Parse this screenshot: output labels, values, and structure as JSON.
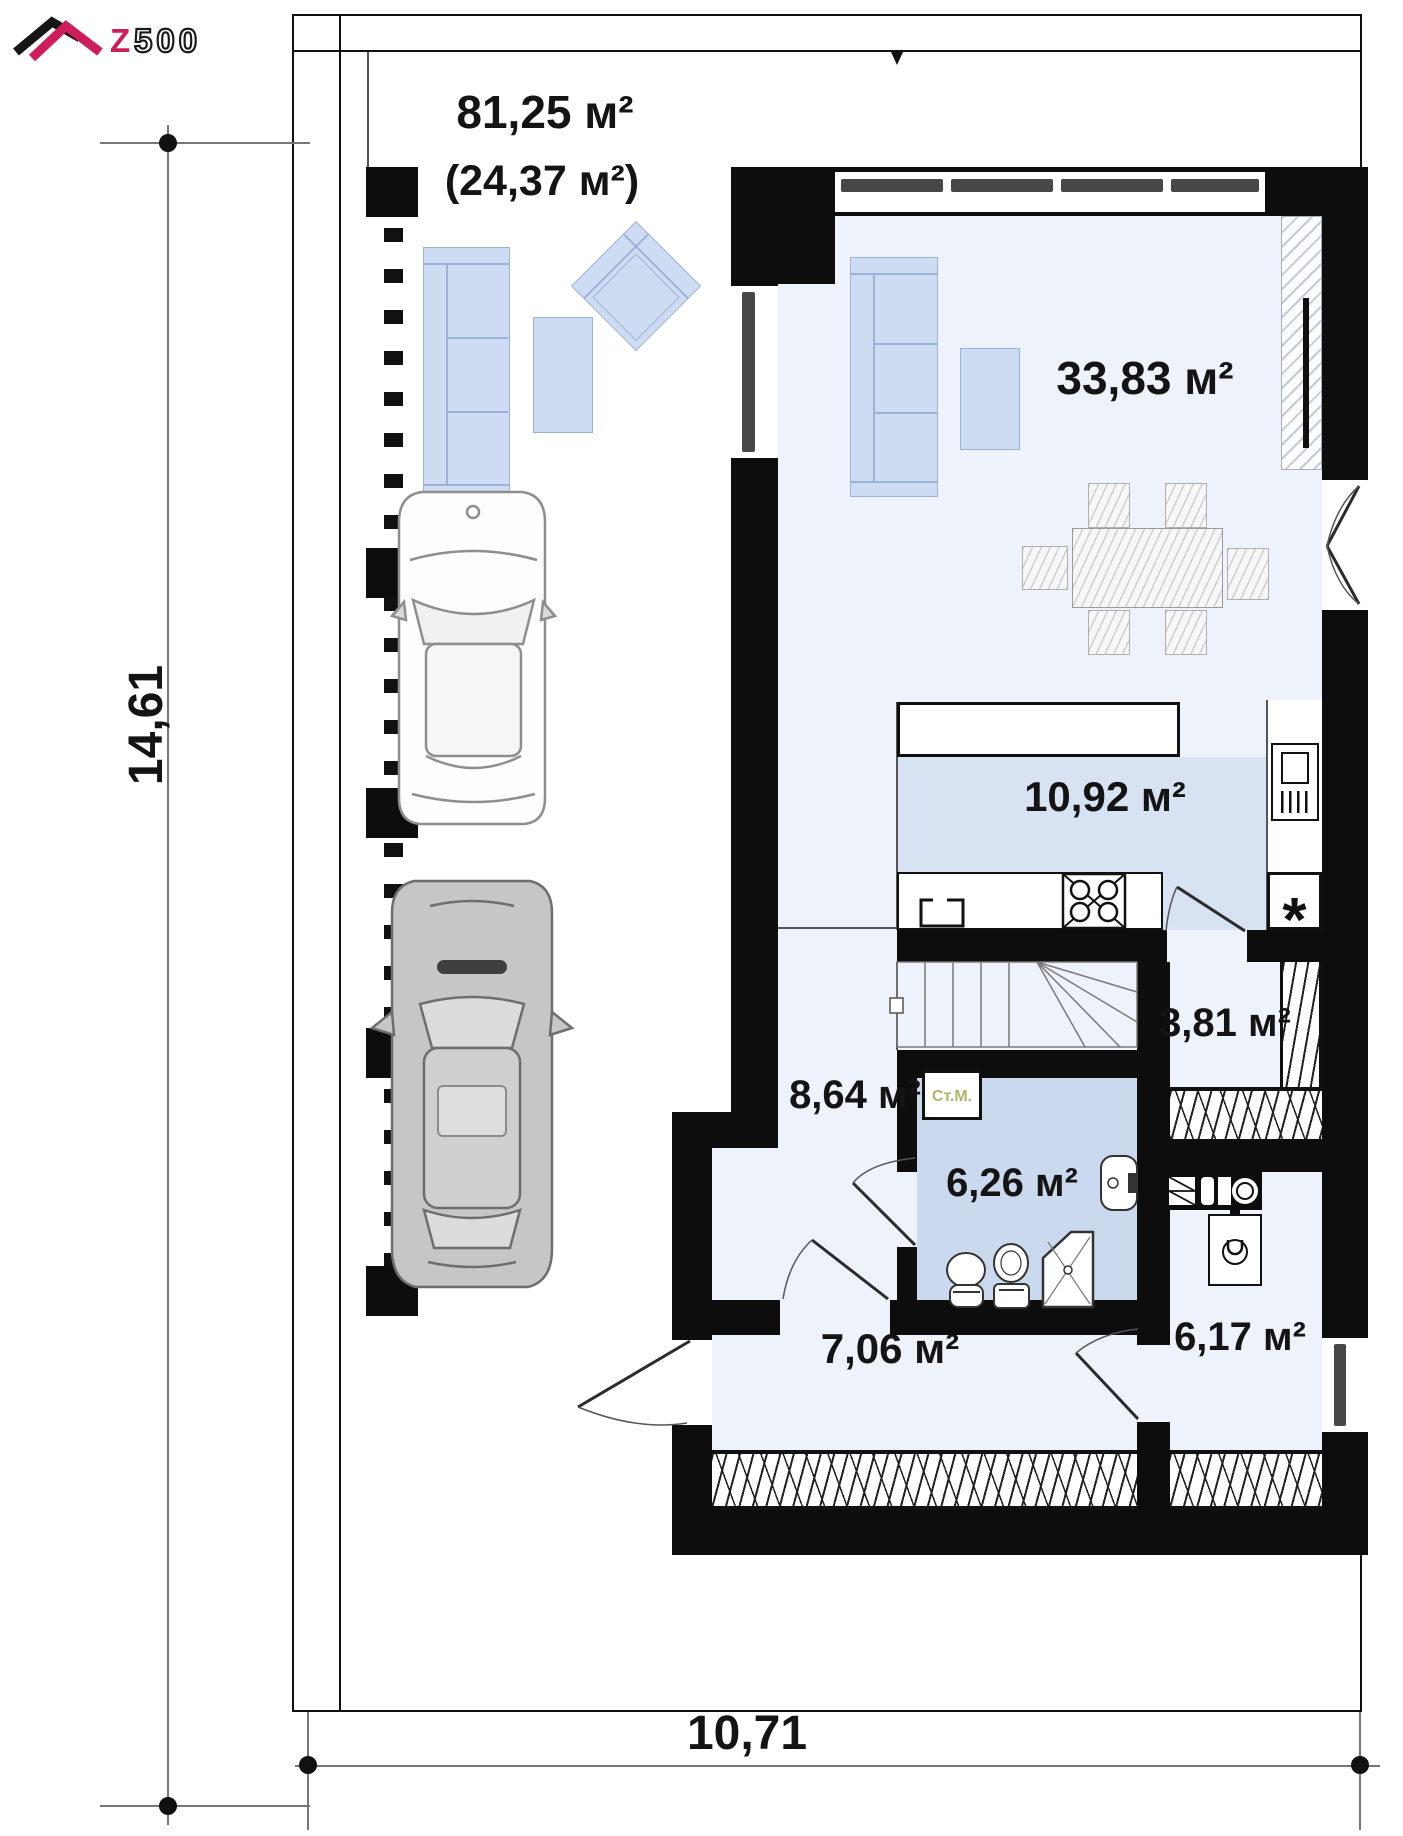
{
  "title": "Z500 first floor plan",
  "logo": {
    "z": "Z",
    "rest": "500",
    "brand_color": "#ce1d5c"
  },
  "dimensions": {
    "left": "14,61",
    "bottom": "10,71"
  },
  "areas": {
    "carport_total": "81,25 м²",
    "carport_roofed": "(24,37 м²)",
    "living_room": "33,83 м²",
    "kitchen": "10,92 м²",
    "pantry": "3,81 м²",
    "hall": "8,64 м²",
    "bathroom": "6,26 м²",
    "entry": "7,06 м²",
    "utility": "6,17 м²"
  },
  "annotations": {
    "washing_machine": "Ст.М.",
    "boiler": "*"
  },
  "colors": {
    "wall": "#0d0d0d",
    "floor_light": "#edf2fb",
    "floor_kitchen": "#d7e2f3",
    "floor_bath": "#cbd9ee",
    "furniture_blue": "#cddcf2",
    "brand": "#ce1d5c"
  }
}
